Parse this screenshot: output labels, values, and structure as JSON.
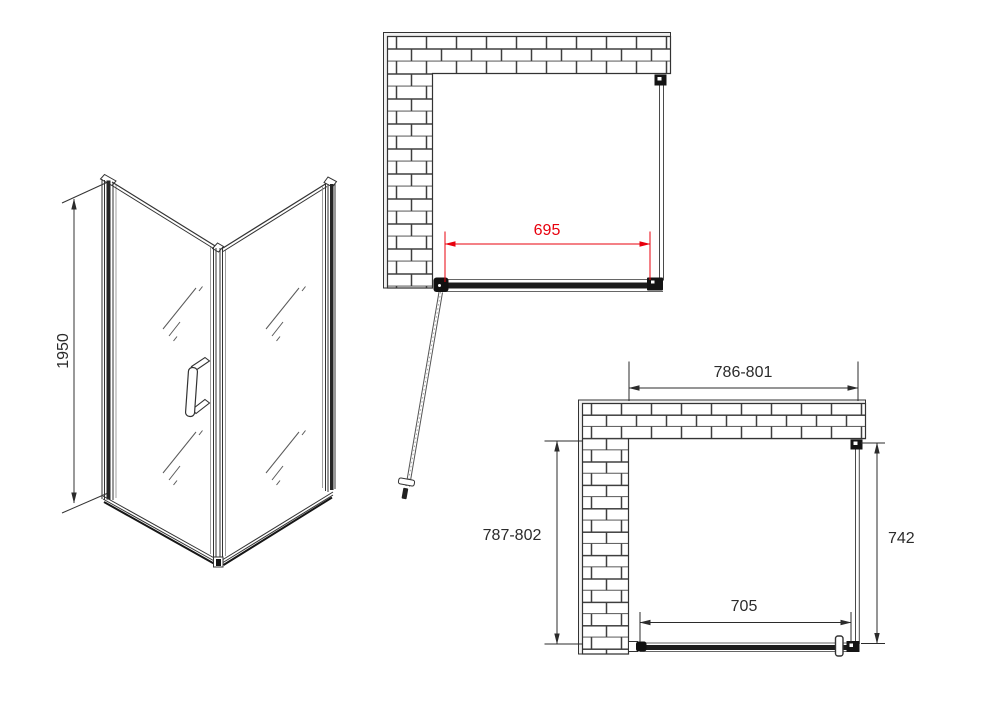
{
  "labels": {
    "iso_height": "1950",
    "door_width": "695",
    "overall_width": "786-801",
    "overall_depth": "787-802",
    "side_panel_depth": "742",
    "door_opening_width": "705"
  },
  "colors": {
    "accent_red": "#e8000d",
    "line_dark": "#2b2b2b"
  }
}
